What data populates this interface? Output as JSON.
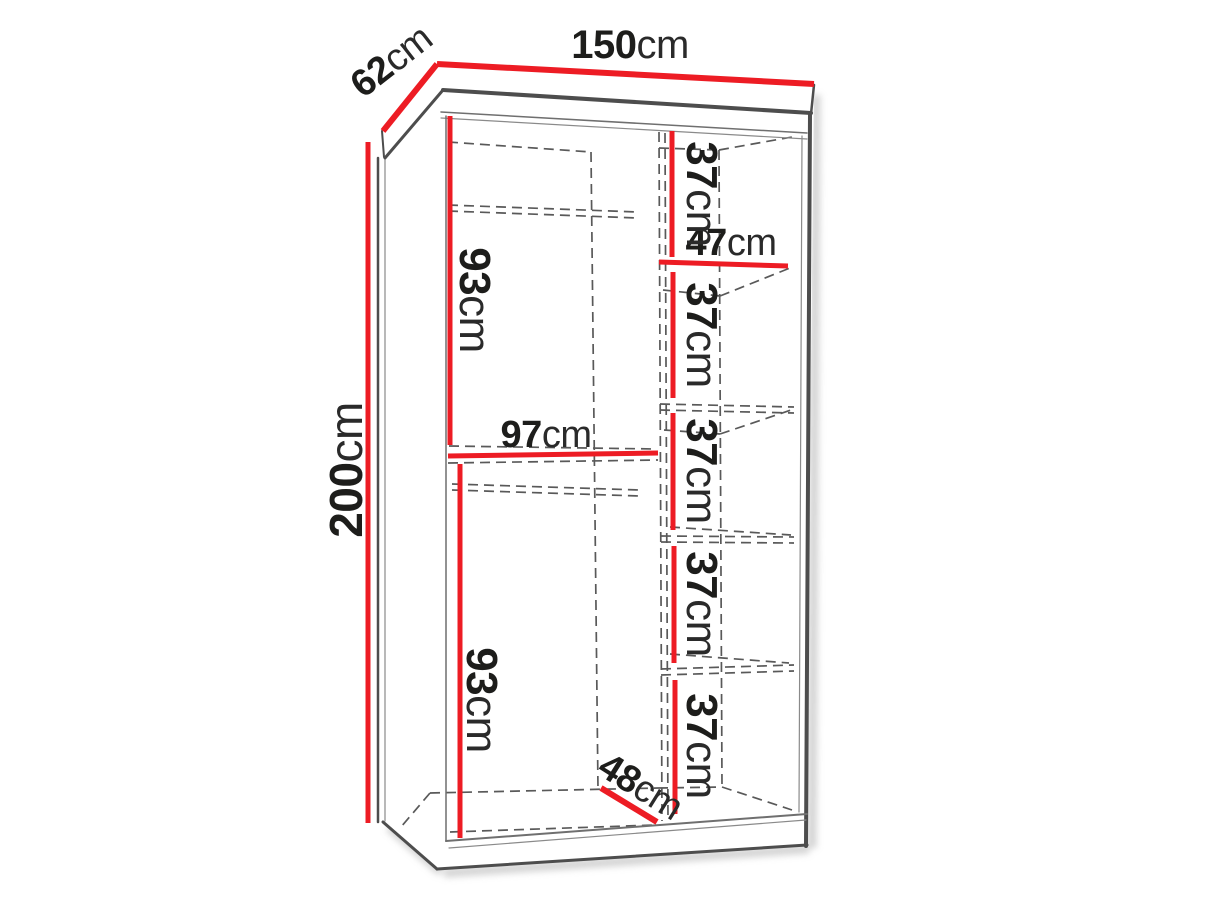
{
  "diagram": {
    "type": "wardrobe-interior-dimension-diagram",
    "units": "cm",
    "colors": {
      "dimension_red": "#ed1c24",
      "outline_gray": "#4d4d4d",
      "hidden_line_gray": "#595959",
      "text": "#1d1d1b",
      "background": "#ffffff"
    },
    "labels": {
      "width": {
        "value": "150",
        "unit": "cm"
      },
      "depth": {
        "value": "62",
        "unit": "cm"
      },
      "height": {
        "value": "200",
        "unit": "cm"
      },
      "upper_hanging": {
        "value": "93",
        "unit": "cm"
      },
      "lower_hanging": {
        "value": "93",
        "unit": "cm"
      },
      "left_compartment_width": {
        "value": "97",
        "unit": "cm"
      },
      "shelf_width": {
        "value": "47",
        "unit": "cm"
      },
      "shelf_gaps": [
        {
          "value": "37",
          "unit": "cm"
        },
        {
          "value": "37",
          "unit": "cm"
        },
        {
          "value": "37",
          "unit": "cm"
        },
        {
          "value": "37",
          "unit": "cm"
        },
        {
          "value": "37",
          "unit": "cm"
        }
      ],
      "interior_depth": {
        "value": "48",
        "unit": "cm"
      }
    }
  }
}
